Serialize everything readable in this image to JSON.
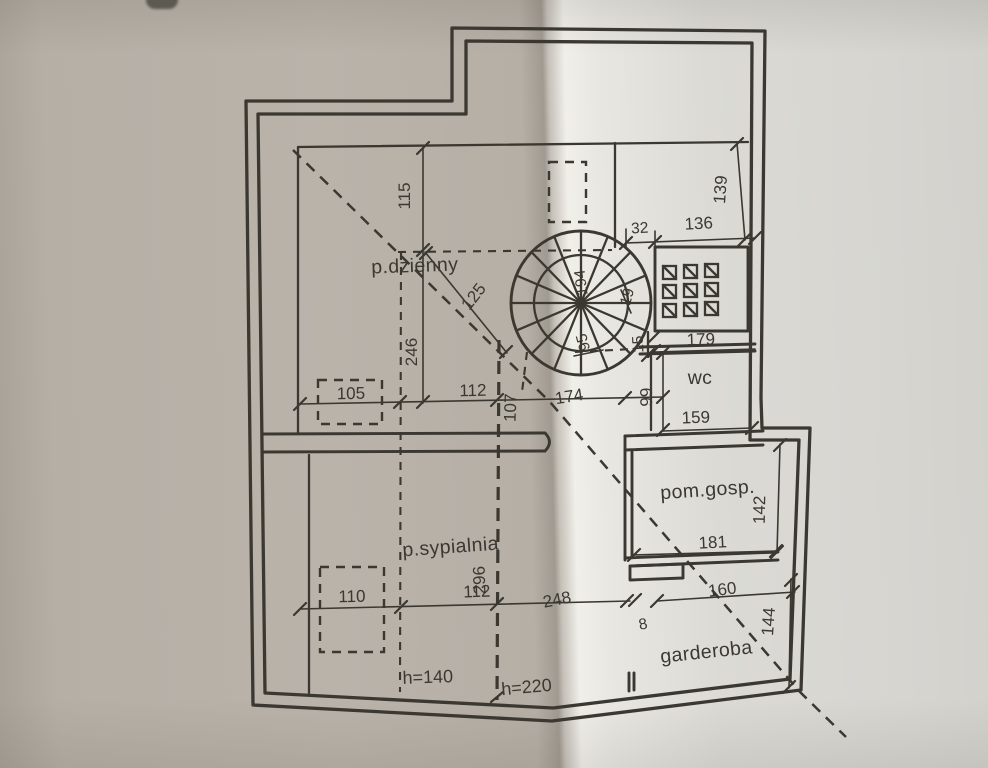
{
  "theme": {
    "paper_left": "#b5afa6",
    "paper_right": "#dbdad5",
    "fold_highlight": "#f0efe9",
    "fold_shadow": "#a09a91",
    "ink": "#3b3831"
  },
  "plan": {
    "rooms": {
      "living": "p.dzienny",
      "bedroom": "p.sypialnia",
      "wc": "wc",
      "utility": "pom.gosp.",
      "wardrobe": "garderoba"
    },
    "ceiling_heights": {
      "low": "h=140",
      "high": "h=220"
    },
    "dims": {
      "d115": "115",
      "d246": "246",
      "d125": "125",
      "d105": "105",
      "d112a": "112",
      "d107": "107",
      "d174": "174",
      "d139": "139",
      "d32": "32",
      "d136": "136",
      "d194": "194",
      "d19": "19",
      "d95": "95",
      "d15": "15",
      "d179": "179",
      "d99": "99",
      "d159": "159",
      "d142": "142",
      "d181": "181",
      "d110": "110",
      "d112b": "112",
      "d296": "296",
      "d248": "248",
      "d8": "8",
      "d160": "160",
      "d144": "144"
    }
  }
}
